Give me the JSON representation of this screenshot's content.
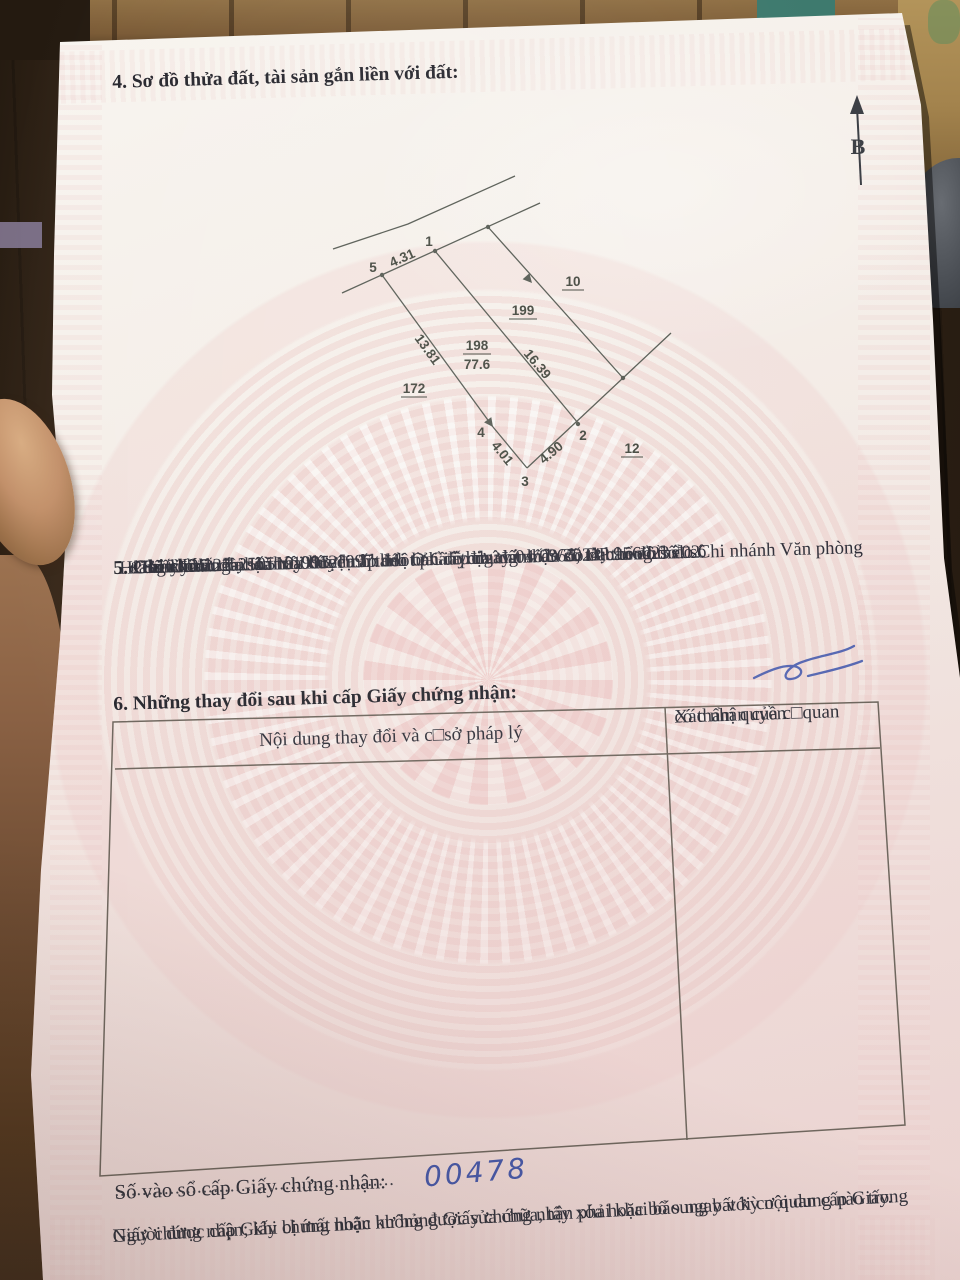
{
  "certificate": {
    "section4_title": "4. Sơ đồ thửa đất, tài sản gắn liền với đất:",
    "section5": {
      "title": "5. Ghi chú:",
      "lines": [
        "+ Số tờ bản đồ, số thửa xác định theo bản đồ địa chính do đo đạc tổng thể.",
        "+ Giấy chứng nhận này được cấp đổi từ Giấy chứng nhận số DP 956023 do Chi nhánh Văn phòng",
        "đăng ký đất đai Hà Nội huyện Thanh Oai cấp ngày 04/09/2024; theo hồ s□sô",
        "H26.103.25.25-250519-0012.",
        "+ Bản đồ đo đạc năm 1995-1997: Một phần thửa đất số 365, tờ bản đồ số 02."
      ]
    },
    "section6": {
      "title": "6. Những thay đổi sau khi cấp Giấy chứng nhận:",
      "col1_header": "Nội dung thay đổi và c□sở pháp lý",
      "col2_header_line1": "Xác nhận của c□quan",
      "col2_header_line2": "có thẩm quyền"
    },
    "register": {
      "label": "Số vào sổ cấp Giấy chứng nhận:",
      "dots": "...................................................",
      "number": "00478"
    },
    "footer": {
      "line1": "Người được cấp Giấy chứng nhận không được sửa chữa, tẩy xóa hoặc bổ sung bất kỳ nội dung nào trong",
      "line2": "Giấy chứng nhận; khi bị mất hoặc hư hỏng Giấy chứng nhận phải khai báo ngay với cơ quan cấp Giấy."
    }
  },
  "diagram": {
    "north_label": "B",
    "parcel": {
      "id": "198",
      "area": "77.6"
    },
    "vertex_labels": {
      "v1": "1",
      "v2": "2",
      "v3": "3",
      "v4": "4",
      "v5": "5"
    },
    "edge_lengths": {
      "e5_1": "4.31",
      "e1_2": "16.39",
      "e5_4": "13.81",
      "e4_3": "4.01",
      "e3_2": "4.90"
    },
    "adjacent": {
      "left": "172",
      "middle": "199",
      "top_right": "10",
      "bottom_right": "12"
    }
  },
  "colors": {
    "ink": "#2f2f36",
    "blue_ink": "#3b4fa5",
    "paper": "#f5f1ea",
    "pattern_pink": "#eec6c4",
    "table_border": "#6f675e"
  }
}
